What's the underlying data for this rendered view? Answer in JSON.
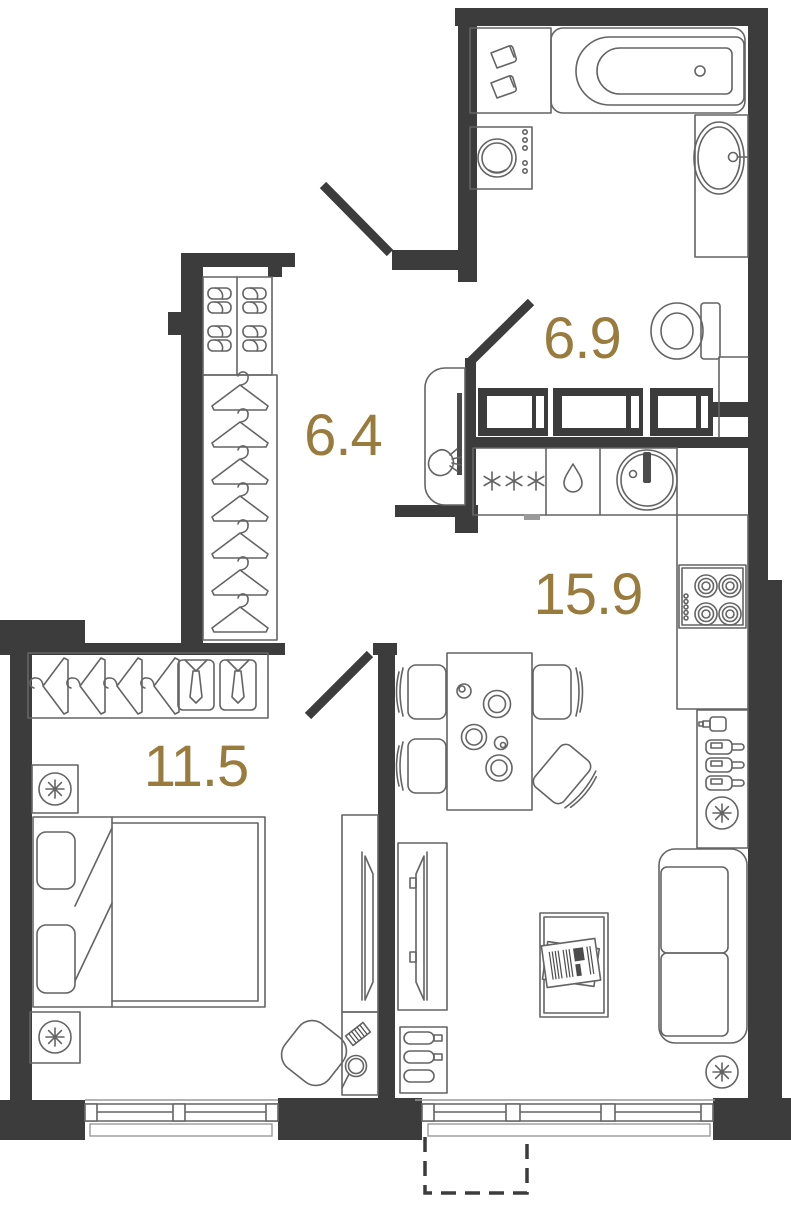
{
  "plan": {
    "type": "apartment-floor-plan",
    "rooms": [
      {
        "name": "bathroom",
        "area_label": "6.9"
      },
      {
        "name": "hallway",
        "area_label": "6.4"
      },
      {
        "name": "kitchen-living-room",
        "area_label": "15.9"
      },
      {
        "name": "bedroom",
        "area_label": "11.5"
      }
    ],
    "colors": {
      "wall": "#3d3c3c",
      "furniture_outline": "#646464",
      "thin_outline": "#9a9a9a",
      "area_label": "#9a7b3e",
      "background": "#ffffff"
    },
    "doors": [
      "entrance-door",
      "bathroom-door",
      "bedroom-door"
    ],
    "furniture_icons": {
      "bathroom": [
        "shelf-with-bottles",
        "bathtub",
        "washing-machine",
        "oval-sink",
        "faucet",
        "toilet"
      ],
      "hallway": [
        "shoe-rack",
        "slippers",
        "wardrobe",
        "clothes-hangers",
        "hall-mirror",
        "sconce"
      ],
      "kitchen_living": [
        "vent-duct",
        "fridge-snowflakes",
        "dishwasher-drop",
        "round-sink",
        "cooktop-4-burners",
        "bar-cabinet",
        "shaker",
        "wine-bottles",
        "radiator",
        "dining-table",
        "plates",
        "dining-chairs",
        "sofa",
        "coffee-table",
        "newspapers",
        "tv-console",
        "tv",
        "shoe-cabinet",
        "window",
        "french-balcony"
      ],
      "bedroom": [
        "wardrobe-hangers",
        "shirts-with-ties",
        "nightstand-lamp",
        "double-bed",
        "pillows",
        "blanket-fold",
        "dressing-table",
        "comb",
        "hand-mirror",
        "chair",
        "tv-console",
        "tv",
        "window"
      ]
    }
  }
}
